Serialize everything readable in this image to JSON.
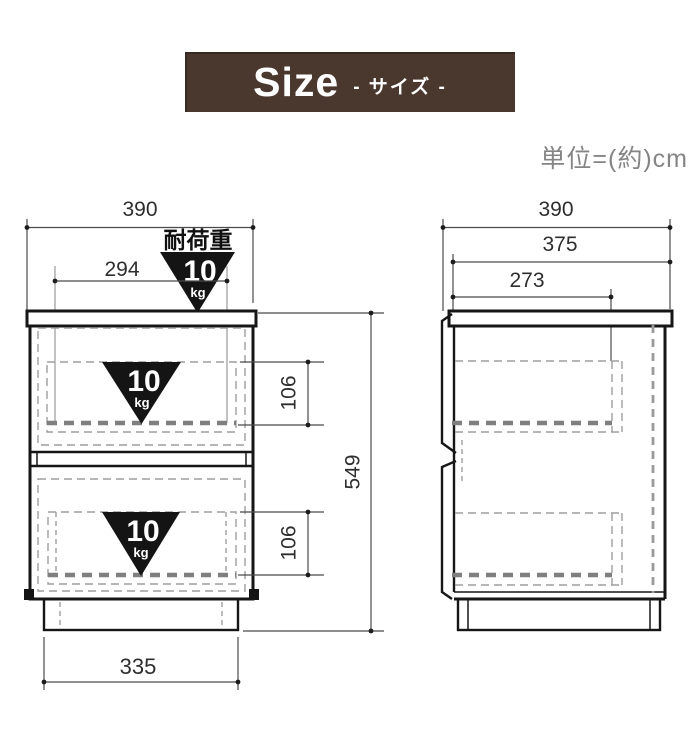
{
  "header": {
    "title": "Size",
    "subtitle": "- サイズ -",
    "bg_color": "#4a382f",
    "text_color": "#ffffff"
  },
  "unit_note": "単位=(約)cm",
  "load_capacity": {
    "label": "耐荷重",
    "value": "10",
    "unit": "kg"
  },
  "front_view": {
    "outer_width": "390",
    "inner_width": "294",
    "upper_drawer_inner_height": "106",
    "lower_drawer_inner_height": "106",
    "overall_height": "549",
    "base_width": "335"
  },
  "side_view": {
    "outer_depth": "390",
    "top_board_depth": "375",
    "inner_depth": "273"
  },
  "colors": {
    "header_bg": "#4a382f",
    "line": "#161616",
    "dashed_line": "#9e9e9e",
    "dim_text": "#2e2e2e",
    "unit_text": "#858585",
    "triangle_fill": "#141414"
  }
}
